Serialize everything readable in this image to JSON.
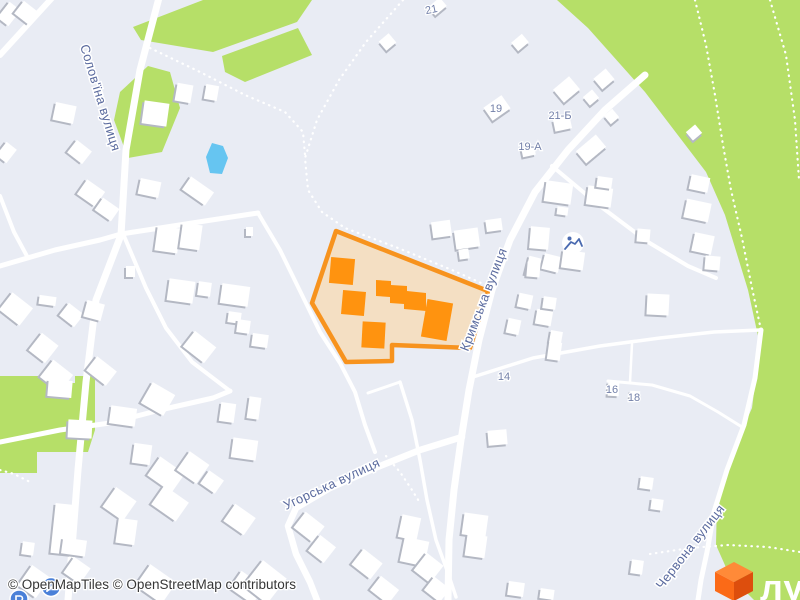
{
  "map": {
    "street_labels": [
      {
        "name": "Солов'їна вулиця"
      },
      {
        "name": "Кримська вулиця"
      },
      {
        "name": "Угорська вулиця"
      },
      {
        "name": "Червона вулиця"
      }
    ],
    "house_numbers": {
      "n21": "21",
      "n19": "19",
      "n21b": "21-Б",
      "n19a": "19-А",
      "n14": "14",
      "n16": "16",
      "n18": "18"
    },
    "colors": {
      "background": "#e9ecf4",
      "greenery": "#b6df68",
      "water": "#66c5f1",
      "road": "#ffffff",
      "building": "#ffffff",
      "building_shadow": "#b4b8c3",
      "highlight_stroke": "#f7931e",
      "highlight_fill": "#f4dfc3",
      "highlight_building": "#ff930f",
      "street_label": "#5a6a9e",
      "house_number": "#7380a9",
      "poi_blue": "#4a80d8"
    }
  },
  "attribution": {
    "text": "© OpenMapTiles © OpenStreetMap contributors"
  },
  "logo": {
    "text": "лун",
    "cube_top": "#ff8a38",
    "cube_left": "#fb6a17",
    "cube_right": "#dd4e0d"
  }
}
